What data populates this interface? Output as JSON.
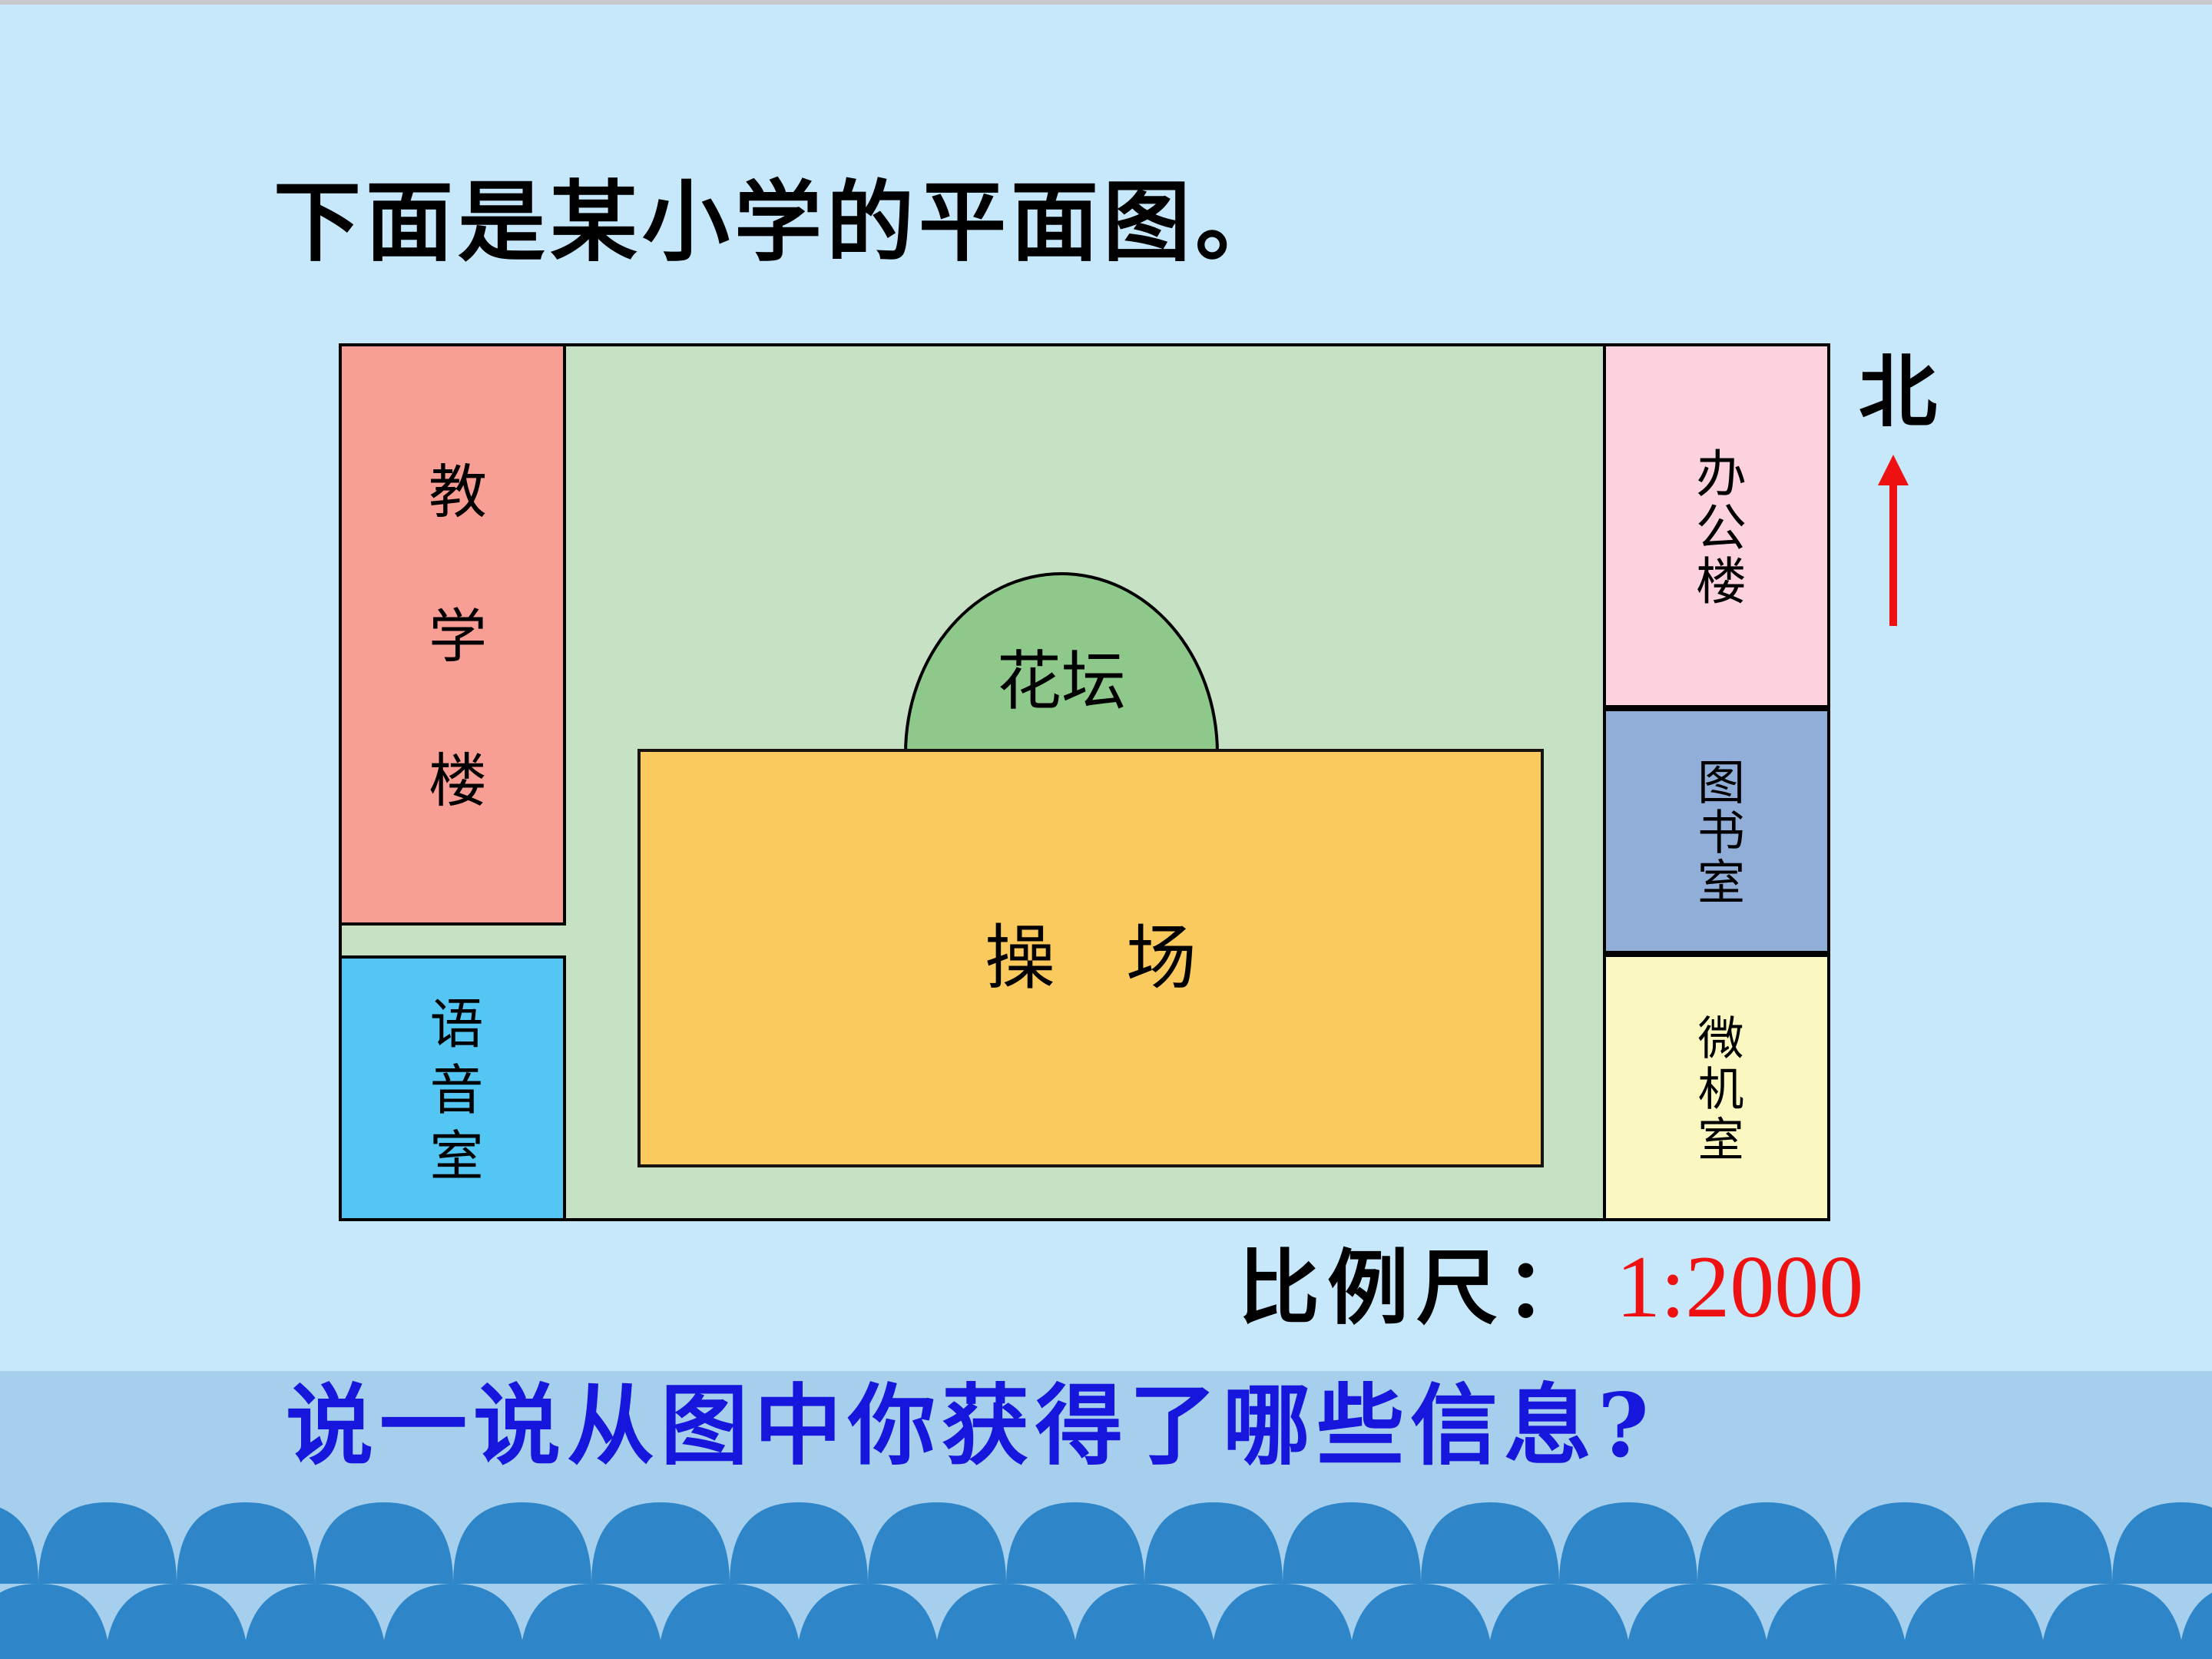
{
  "slide": {
    "title": "下面是某小学的平面图。",
    "question": "说一说从图中你获得了哪些信息?",
    "scale": {
      "label": "比例尺：",
      "value": "1:2000"
    },
    "compass": {
      "label": "北"
    }
  },
  "map": {
    "campus_color": "#C6E1C3",
    "rooms": [
      {
        "id": "teaching-building",
        "label": "教学楼",
        "color": "#F99E95"
      },
      {
        "id": "language-room",
        "label": "语音室",
        "color": "#54C6F4"
      },
      {
        "id": "office-building",
        "label": "办公楼",
        "color": "#FBD2DE"
      },
      {
        "id": "library",
        "label": "图书室",
        "color": "#90AED8"
      },
      {
        "id": "computer-room",
        "label": "微机室",
        "color": "#FAF7C0"
      },
      {
        "id": "flower-bed",
        "label": "花坛",
        "color": "#8FC88B"
      },
      {
        "id": "playground",
        "label": "操　场",
        "color": "#FBCA5F"
      }
    ]
  },
  "colors": {
    "page_background": "#C7E8FA",
    "bottom_band": "#A5CFEC",
    "wave_blue": "#2E86C9",
    "top_strip_gray": "#C9C9CD",
    "scale_value_red": "#EE1111",
    "question_blue": "#1616DC",
    "north_arrow_red": "#EE1111",
    "border_black": "#000000"
  }
}
